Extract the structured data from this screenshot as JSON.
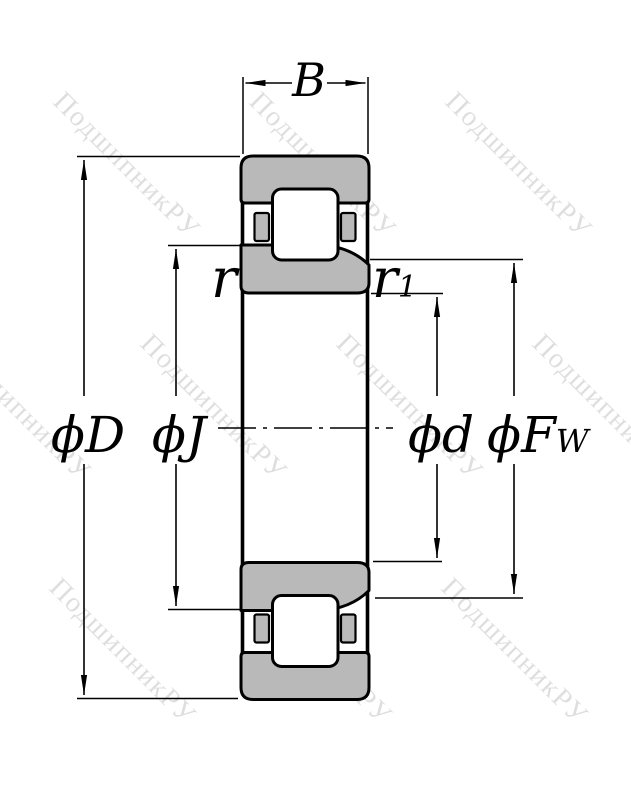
{
  "drawing": {
    "watermark_text": "ПодшипникРУ",
    "dimensions": {
      "b": "B",
      "outer_diameter": "ϕD",
      "rib_diameter": "ϕJ",
      "bore_diameter": "ϕd",
      "raceway_diameter_main": "ϕF",
      "raceway_diameter_sub": "W",
      "chamfer": "r",
      "chamfer1_main": "r",
      "chamfer1_sub": "1"
    },
    "colors": {
      "line": "#000000",
      "ring_fill": "#b9b9b9",
      "watermark": "rgba(0,0,0,0.13)",
      "background": "#ffffff"
    }
  }
}
